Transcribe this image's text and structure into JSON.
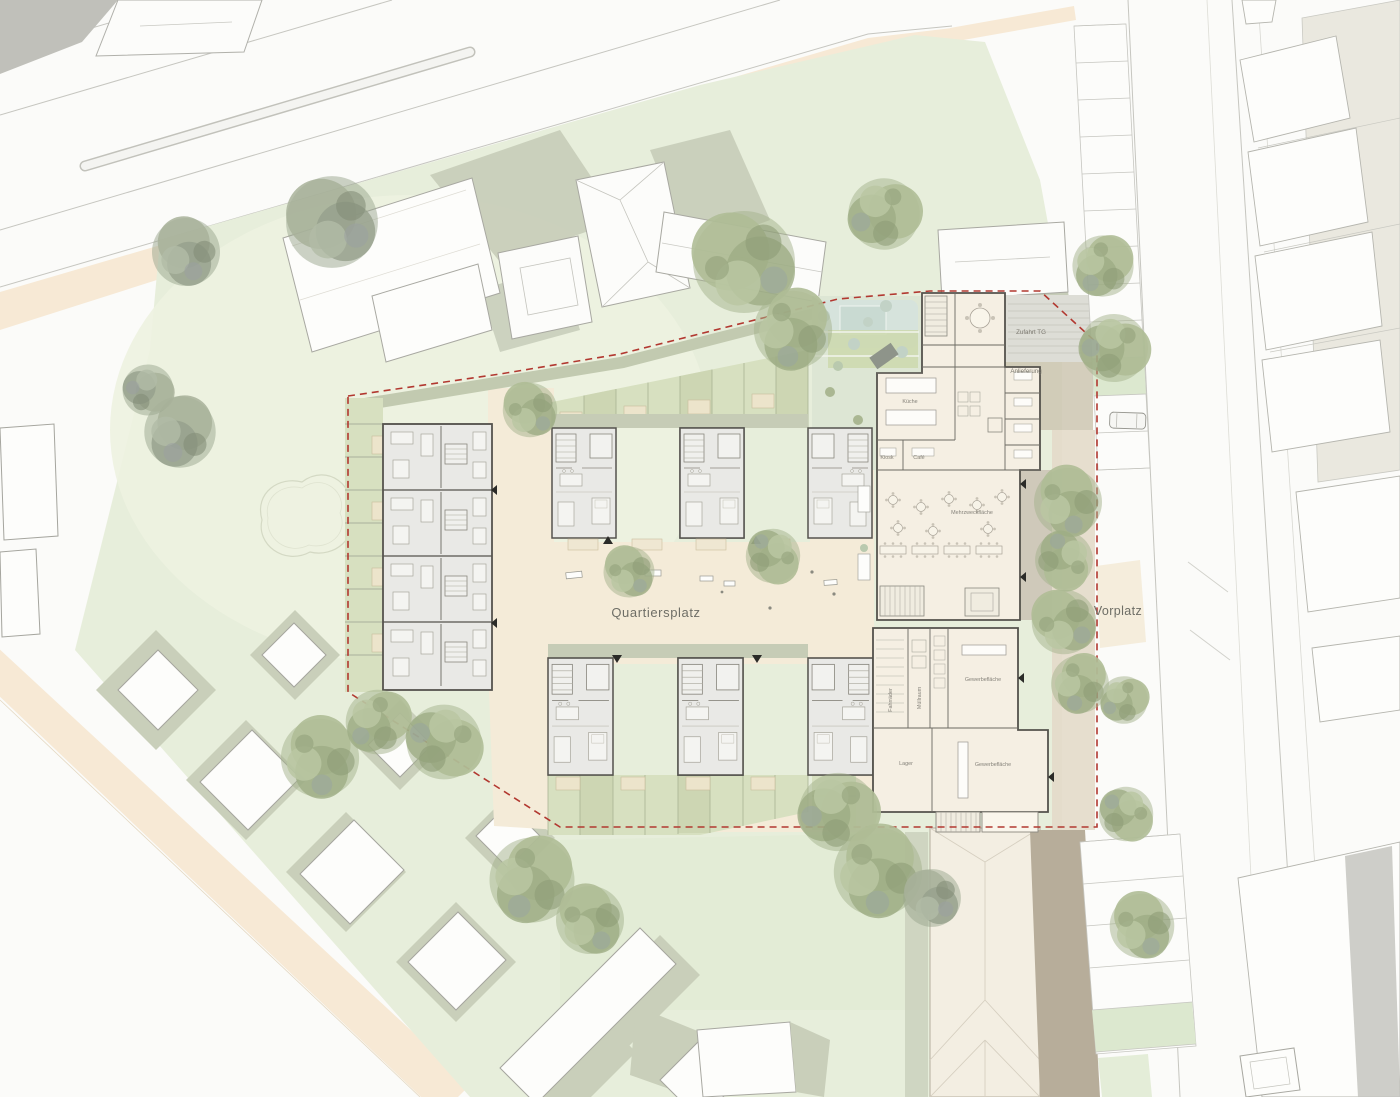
{
  "plan_labels": {
    "quartiersplatz": "Quartiersplatz",
    "vorplatz": "Vorplatz",
    "zufahrt_tg": "Zufahrt TG",
    "anlieferung": "Anlieferung",
    "kueche": "Küche",
    "kiosk": "Kiosk",
    "cafe": "Café",
    "mehrzweckflaeche": "Mehrzweckfläche",
    "fahrraeder": "Fahrräder",
    "muellraum": "Müllraum",
    "gewerbeflaeche_nord": "Gewerbefläche",
    "lager": "Lager",
    "gewerbeflaeche_sued": "Gewerbefläche"
  },
  "colors": {
    "site_boundary_red": "#b23830",
    "lawn_green": "#e7eedb",
    "garden_green": "#d7e0c0",
    "plaza_beige": "#f4ebd8",
    "sidewalk_beige": "#f7e9d5",
    "residential_floorplan_gray": "#e9e9e6",
    "community_floorplan_cream": "#f5efe3",
    "tree_green": "#a3b28c",
    "path_brown": "#b7ad9a",
    "road_white": "#fbfbf9",
    "context_olive": "#c8cfb8"
  }
}
